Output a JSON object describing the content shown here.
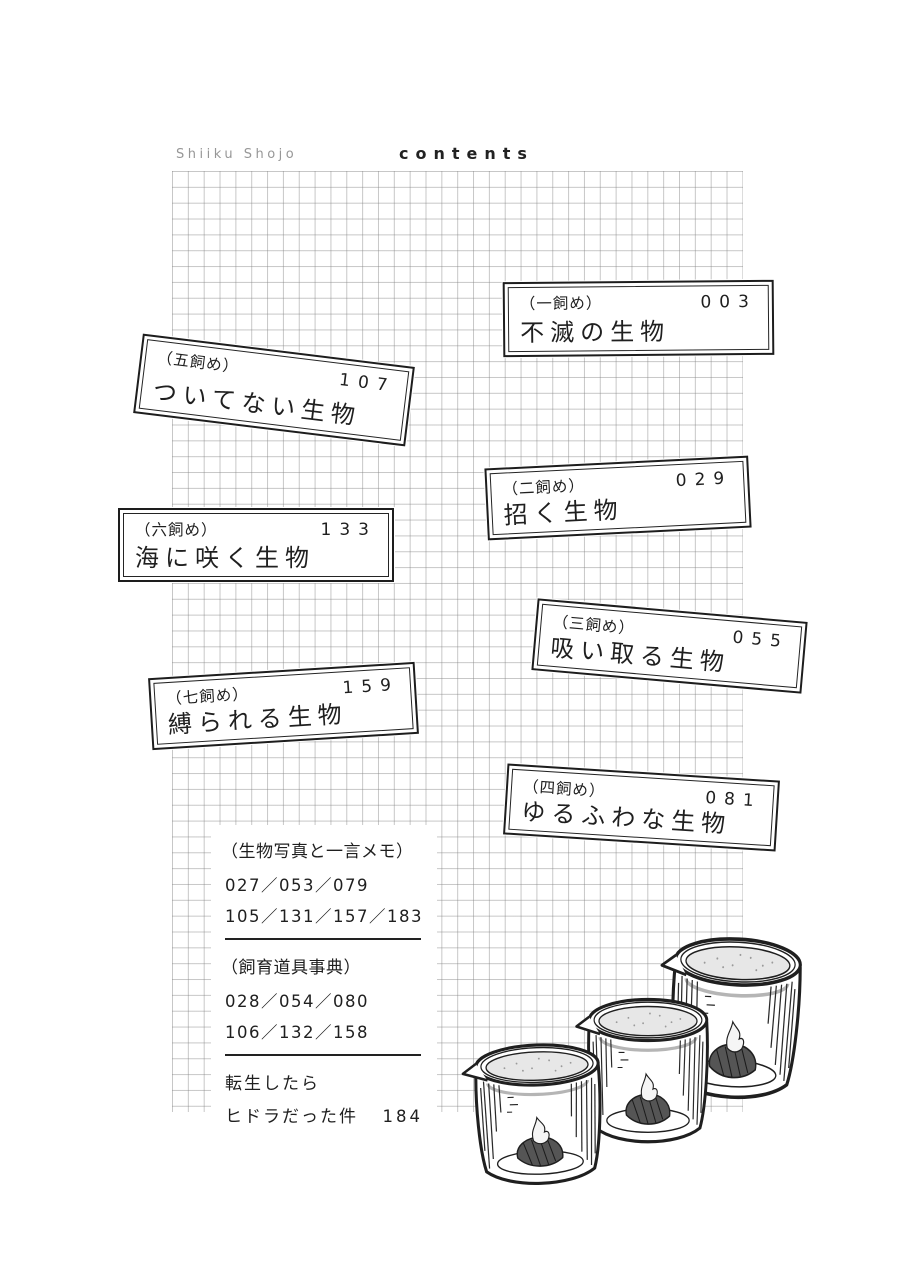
{
  "header": {
    "series_title": "Shiiku Shojo",
    "page_title": "contents"
  },
  "chapters": [
    {
      "label": "（一飼め）",
      "page": "003",
      "title": "不滅の生物"
    },
    {
      "label": "（二飼め）",
      "page": "029",
      "title": "招く生物"
    },
    {
      "label": "（三飼め）",
      "page": "055",
      "title": "吸い取る生物"
    },
    {
      "label": "（四飼め）",
      "page": "081",
      "title": "ゆるふわな生物"
    },
    {
      "label": "（五飼め）",
      "page": "107",
      "title": "ついてない生物"
    },
    {
      "label": "（六飼め）",
      "page": "133",
      "title": "海に咲く生物"
    },
    {
      "label": "（七飼め）",
      "page": "159",
      "title": "縛られる生物"
    }
  ],
  "extras": {
    "photo_memo": {
      "heading": "（生物写真と一言メモ）",
      "pages_line1": "027／053／079",
      "pages_line2": "105／131／157／183"
    },
    "tools": {
      "heading": "（飼育道具事典）",
      "pages_line1": "028／054／080",
      "pages_line2": "106／132／158"
    },
    "bonus": {
      "title_line1": "転生したら",
      "title_line2": "ヒドラだった件",
      "page": "184"
    }
  },
  "illustration": {
    "name": "three-beakers-ink-drawing"
  },
  "colors": {
    "ink": "#1f1f1f",
    "grid_line": "#828282",
    "paper": "#ffffff",
    "liquid": "#e7e7e7"
  }
}
